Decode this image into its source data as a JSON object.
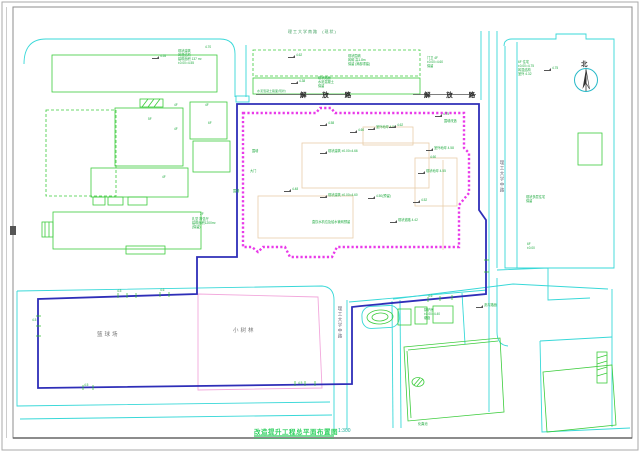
{
  "drawing_title": "改造提升工程总平面布置图",
  "scale": "1:300",
  "north_label": "北",
  "roads": {
    "top_note": "理工大学南路  (现状)",
    "main_road_name_left": "解 放 路",
    "main_road_name_right": "解 放 路",
    "right_road_name": "理工大学中路",
    "bottom_road_name": "理工大学中路",
    "surface_note": "水泥混凝土路面(现状)"
  },
  "areas": {
    "basketball": "篮球场",
    "grove": "小树林"
  },
  "colors": {
    "road_cyan": "#38d8d8",
    "boundary_blue": "#2e2eb8",
    "fence_magenta": "#e93ae9",
    "parcel_pink": "#f2a8dc",
    "building_green": "#3ccc3c",
    "annotation_green": "#1faa3f",
    "existing_tan": "#e8cdaa",
    "title_green": "#2fd060"
  },
  "annotations": [
    {
      "x": 152,
      "y": 54,
      "flag": true,
      "text": "4.55"
    },
    {
      "x": 178,
      "y": 49,
      "text": "现状建筑\n砖混结构\n建筑面积 137 m²\n±0.00=4.55"
    },
    {
      "x": 205,
      "y": 45,
      "text": "4.70"
    },
    {
      "x": 288,
      "y": 53,
      "flag": true,
      "text": "4.62"
    },
    {
      "x": 348,
      "y": 54,
      "text": "现状围墙\n砖砌 高1.8m\n保留 (局部重建)"
    },
    {
      "x": 427,
      "y": 56,
      "text": "门卫 4F\n±0.00=4.60\n保留"
    },
    {
      "x": 291,
      "y": 79,
      "flag": true,
      "text": "4.38"
    },
    {
      "x": 318,
      "y": 76,
      "text": "现状路面\n水泥混凝土\n保留"
    },
    {
      "x": 518,
      "y": 60,
      "text": "6F 住宅\n±0.00=4.75\n砖混结构\n室外 4.32"
    },
    {
      "x": 544,
      "y": 66,
      "flag": true,
      "text": "4.75"
    },
    {
      "x": 252,
      "y": 149,
      "text": "围墙"
    },
    {
      "x": 250,
      "y": 169,
      "text": "大门"
    },
    {
      "x": 233,
      "y": 189,
      "text": "围墙"
    },
    {
      "x": 320,
      "y": 121,
      "flag": true,
      "text": "4.58"
    },
    {
      "x": 350,
      "y": 128,
      "flag": true,
      "text": "4.60"
    },
    {
      "x": 368,
      "y": 125,
      "flag": true,
      "text": "室外地坪 4.56"
    },
    {
      "x": 389,
      "y": 123,
      "flag": true,
      "text": "4.62"
    },
    {
      "x": 435,
      "y": 112,
      "flag": true,
      "text": "4.75"
    },
    {
      "x": 444,
      "y": 119,
      "text": "围墙改造"
    },
    {
      "x": 320,
      "y": 149,
      "flag": true,
      "text": "现状建筑 ±0.00=4.66"
    },
    {
      "x": 426,
      "y": 146,
      "flag": true,
      "text": "室外地坪 4.58"
    },
    {
      "x": 430,
      "y": 155,
      "text": "4.60"
    },
    {
      "x": 418,
      "y": 169,
      "flag": true,
      "text": "现状地坪 4.55"
    },
    {
      "x": 284,
      "y": 187,
      "flag": true,
      "text": "4.48"
    },
    {
      "x": 320,
      "y": 193,
      "flag": true,
      "text": "现状建筑 ±0.00=4.60"
    },
    {
      "x": 368,
      "y": 194,
      "flag": true,
      "text": "4.50(预留)"
    },
    {
      "x": 413,
      "y": 198,
      "flag": true,
      "text": "4.52"
    },
    {
      "x": 312,
      "y": 220,
      "text": "直饮水机位及给水管网预留"
    },
    {
      "x": 390,
      "y": 218,
      "flag": true,
      "text": "现状道路 4.42"
    },
    {
      "x": 526,
      "y": 195,
      "text": "现状多层住宅\n保留"
    },
    {
      "x": 527,
      "y": 242,
      "text": "6F\n±0.00"
    },
    {
      "x": 424,
      "y": 308,
      "text": "锅炉房\n±0.00=4.40\n烟囱"
    },
    {
      "x": 476,
      "y": 303,
      "flag": true,
      "text": "沥青路面"
    },
    {
      "x": 418,
      "y": 422,
      "text": "化粪池"
    },
    {
      "x": 174,
      "y": 103,
      "text": "4F"
    },
    {
      "x": 205,
      "y": 103,
      "text": "4F"
    },
    {
      "x": 208,
      "y": 121,
      "text": "6F"
    },
    {
      "x": 174,
      "y": 127,
      "text": "4F"
    },
    {
      "x": 148,
      "y": 117,
      "text": "5F"
    },
    {
      "x": 162,
      "y": 175,
      "text": "4F"
    },
    {
      "x": 200,
      "y": 212,
      "text": "2F"
    },
    {
      "x": 192,
      "y": 217,
      "text": "礼堂 报告厅\n建筑面积1200m²\n(保留)"
    },
    {
      "x": 117,
      "y": 289,
      "text": "4.5"
    },
    {
      "x": 160,
      "y": 288,
      "text": "4.6"
    },
    {
      "x": 298,
      "y": 381,
      "text": "4.5"
    },
    {
      "x": 84,
      "y": 383,
      "text": "4.5"
    },
    {
      "x": 428,
      "y": 294,
      "text": "4.6"
    },
    {
      "x": 32,
      "y": 318,
      "text": "4.5"
    }
  ]
}
